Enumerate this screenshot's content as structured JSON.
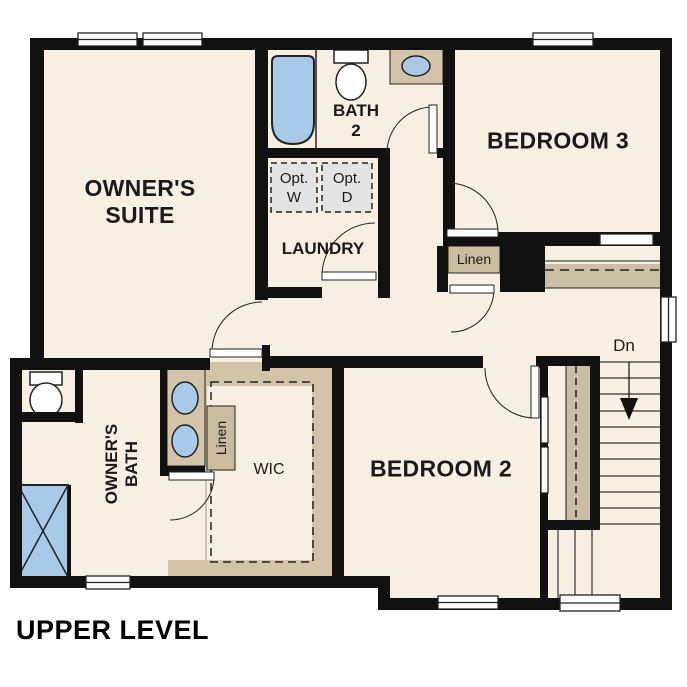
{
  "plan": {
    "title": "UPPER LEVEL",
    "stairs_direction": "Dn"
  },
  "rooms": {
    "owners_suite": {
      "label": "OWNER'S SUITE",
      "line1": "OWNER'S",
      "line2": "SUITE"
    },
    "bath_2": {
      "label": "BATH 2",
      "line1": "BATH",
      "line2": "2"
    },
    "bedroom_3": {
      "label": "BEDROOM 3"
    },
    "laundry": {
      "label": "LAUNDRY"
    },
    "owners_bath": {
      "label": "OWNER'S BATH",
      "line1": "OWNER'S",
      "line2": "BATH"
    },
    "wic": {
      "label": "WIC"
    },
    "bedroom_2": {
      "label": "BEDROOM 2"
    }
  },
  "closets": {
    "hall_linen": {
      "label": "Linen"
    },
    "bath_linen": {
      "label": "Linen"
    }
  },
  "appliances": {
    "optional_washer": {
      "label": "Opt. W",
      "line1": "Opt.",
      "line2": "W"
    },
    "optional_dryer": {
      "label": "Opt. D",
      "line1": "Opt.",
      "line2": "D"
    }
  },
  "colors": {
    "floor": "#F7EFE2",
    "wall": "#111111",
    "casework_tan": "#D2C3A9",
    "plumbing_blue": "#A9C9E9",
    "appliance_gray": "#E3E3E3",
    "exterior": "#FFFFFF"
  }
}
